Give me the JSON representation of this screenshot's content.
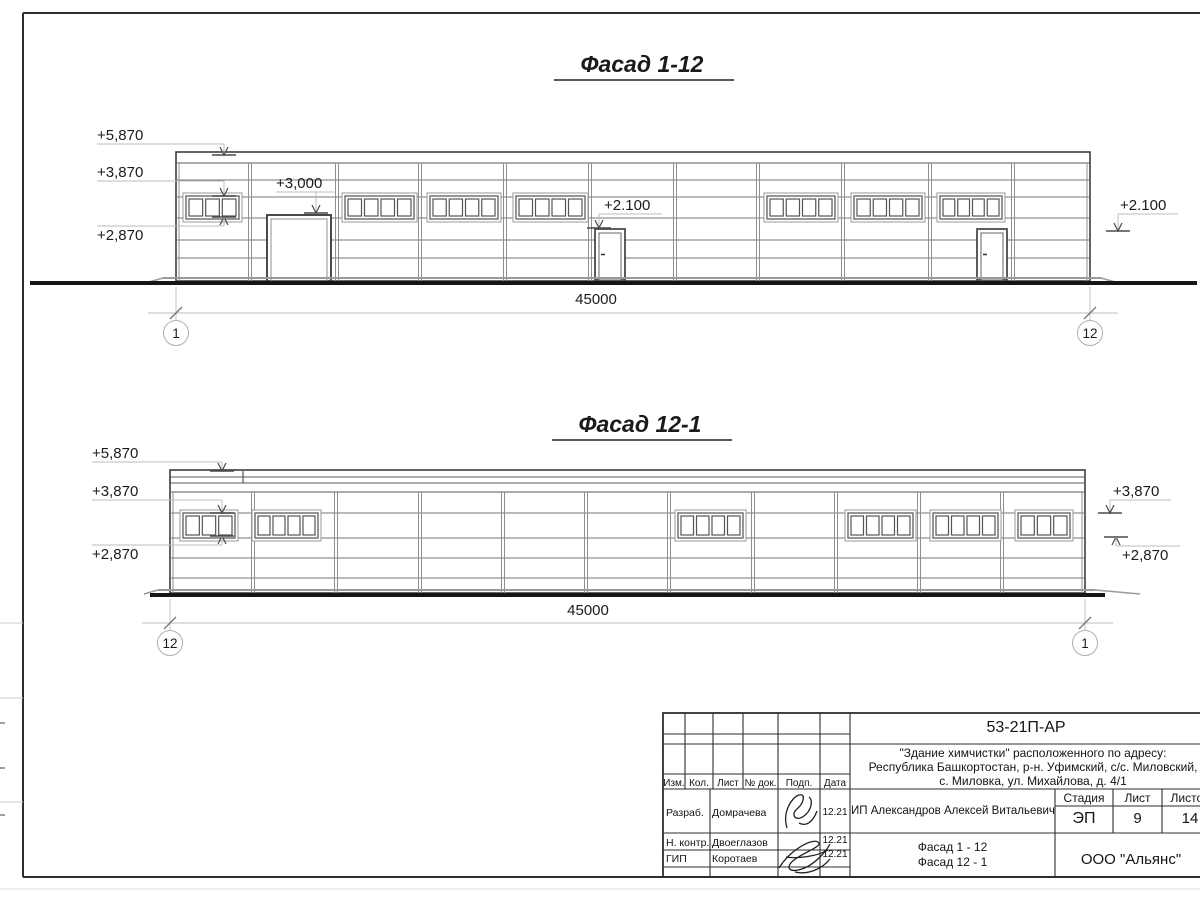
{
  "drawing": {
    "facades": [
      {
        "name": "facade-1-12",
        "title": "Фасад 1-12",
        "title_cx": 642,
        "title_y": 72,
        "x1": 176,
        "x2": 1090,
        "top": 152,
        "ground": 283,
        "col_top": 163,
        "band_lines": [
          163
        ],
        "wall_lines": [
          180,
          197,
          218,
          240,
          258
        ],
        "columns": [
          250,
          337,
          420,
          505,
          590,
          675,
          758,
          843,
          930,
          1013
        ],
        "win_y": 196,
        "win_h": 23,
        "windows": [
          {
            "x": 186,
            "w": 53,
            "panes": 3
          },
          {
            "x": 345,
            "w": 69,
            "panes": 4
          },
          {
            "x": 430,
            "w": 68,
            "panes": 4
          },
          {
            "x": 516,
            "w": 69,
            "panes": 4
          },
          {
            "x": 767,
            "w": 68,
            "panes": 4
          },
          {
            "x": 854,
            "w": 68,
            "panes": 4
          },
          {
            "x": 940,
            "w": 62,
            "panes": 4
          }
        ],
        "doors": [
          {
            "x": 595,
            "w": 30,
            "top": 229
          },
          {
            "x": 977,
            "w": 30,
            "top": 229
          }
        ],
        "gate": {
          "x": 267,
          "w": 64,
          "top": 215
        },
        "ground_line": {
          "x1": 30,
          "x2": 1197
        },
        "found_line": {
          "x1": 163,
          "x2": 1101
        },
        "ramp_right": 14,
        "marks": [
          {
            "label": "+5,870",
            "tx": 97,
            "ty": 140,
            "ax": 224,
            "tick": 155,
            "dir": "down"
          },
          {
            "label": "+3,870",
            "tx": 97,
            "ty": 177,
            "ax": 224,
            "tick": 196,
            "dir": "down"
          },
          {
            "label": "+2,870",
            "tx": 97,
            "ty": 231,
            "ax": 224,
            "tick": 217,
            "dir": "up"
          },
          {
            "label": "+3,000",
            "tx": 276,
            "ty": 188,
            "ax": 316,
            "tick": 213,
            "dir": "down"
          },
          {
            "label": "+2.100",
            "tx": 604,
            "ty": 210,
            "ax": 599,
            "tick": 228,
            "dir": "down"
          },
          {
            "label": "+2.100",
            "tx": 1120,
            "ty": 210,
            "ax": 1118,
            "tick": 231,
            "dir": "down"
          }
        ],
        "dim": {
          "y": 313,
          "label": "45000",
          "label_cx": 596,
          "label_y": 304,
          "bubbles": [
            {
              "label": "1",
              "x": 176
            },
            {
              "label": "12",
              "x": 1090
            }
          ]
        }
      },
      {
        "name": "facade-12-1",
        "title": "Фасад 12-1",
        "title_cx": 640,
        "title_y": 432,
        "x1": 170,
        "x2": 1085,
        "top": 470,
        "ground": 595,
        "col_top": 492,
        "band_lines": [
          477,
          483,
          492
        ],
        "band_joint": 243,
        "wall_lines": [
          513,
          538,
          558,
          578
        ],
        "columns": [
          253,
          336,
          420,
          503,
          586,
          669,
          753,
          836,
          919,
          1002
        ],
        "win_y": 513,
        "win_h": 25,
        "windows": [
          {
            "x": 183,
            "w": 52,
            "panes": 3
          },
          {
            "x": 255,
            "w": 63,
            "panes": 4
          },
          {
            "x": 678,
            "w": 65,
            "panes": 4
          },
          {
            "x": 848,
            "w": 65,
            "panes": 4
          },
          {
            "x": 933,
            "w": 65,
            "panes": 4
          },
          {
            "x": 1018,
            "w": 52,
            "panes": 3
          }
        ],
        "doors": [],
        "ground_line": {
          "x1": 150,
          "x2": 1105
        },
        "found_line": {
          "x1": 158,
          "x2": 1095
        },
        "ramp_right": 45,
        "marks": [
          {
            "label": "+5,870",
            "tx": 92,
            "ty": 458,
            "ax": 222,
            "tick": 471,
            "dir": "down"
          },
          {
            "label": "+3,870",
            "tx": 92,
            "ty": 496,
            "ax": 222,
            "tick": 513,
            "dir": "down"
          },
          {
            "label": "+2,870",
            "tx": 92,
            "ty": 545,
            "ax": 222,
            "tick": 536,
            "dir": "up"
          },
          {
            "label": "+3,870",
            "tx": 1113,
            "ty": 496,
            "ax": 1110,
            "tick": 513,
            "dir": "down"
          },
          {
            "label": "+2,870",
            "tx": 1122,
            "ty": 546,
            "ax": 1116,
            "tick": 537,
            "dir": "up"
          }
        ],
        "dim": {
          "y": 623,
          "label": "45000",
          "label_cx": 588,
          "label_y": 615,
          "bubbles": [
            {
              "label": "12",
              "x": 170
            },
            {
              "label": "1",
              "x": 1085
            }
          ]
        }
      }
    ]
  },
  "title_block": {
    "doc_number": "53-21П-АР",
    "project_line1": "\"Здание химчистки\" расположенного по адресу:",
    "project_line2": "Республика Башкортостан, р-н. Уфимский, с/с. Миловский,",
    "project_line3": "с. Миловка, ул. Михайлова, д. 4/1",
    "client": "ИП Александров Алексей Витальевич",
    "sheet_title_line1": "Фасад 1 - 12",
    "sheet_title_line2": "Фасад 12 - 1",
    "company": "ООО \"Альянс\"",
    "stage_header": "Стадия",
    "sheet_header": "Лист",
    "sheets_header": "Листов",
    "stage": "ЭП",
    "sheet_no": "9",
    "sheets_total": "14",
    "cols": {
      "izm": "Изм.",
      "kol": "Кол.",
      "list": "Лист",
      "doc": "№ док.",
      "podp": "Подп.",
      "data": "Дата"
    },
    "rows": [
      {
        "role": "Разраб.",
        "name": "Домрачева",
        "date": "12.21"
      },
      {
        "role": "Н. контр.",
        "name": "Двоеглазов",
        "date": "12.21"
      },
      {
        "role": "ГИП",
        "name": "Коротаев",
        "date": "12.21"
      }
    ]
  }
}
